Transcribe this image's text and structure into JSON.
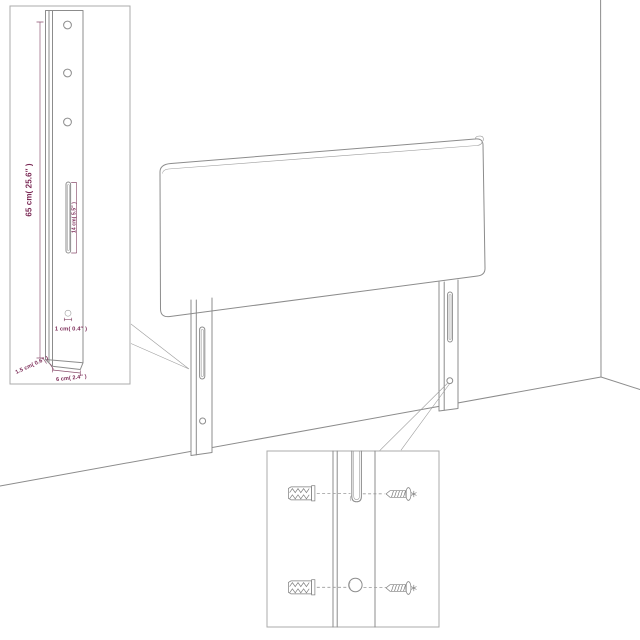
{
  "diagram": {
    "type": "furniture-assembly-illustration",
    "subject": "upholstered headboard with two wall-mount legs standing in a room corner",
    "insets": {
      "leg_detail": {
        "hole_count": 3,
        "labels": {
          "leg_height": "65 cm( 25.6″ )",
          "slot_length": "14 cm( 5.5″ )",
          "hook_depth": "1 cm( 0.4″ )",
          "leg_thickness": "1.5 cm( 0.6″ )",
          "leg_width": "6 cm( 2.4″ )"
        }
      },
      "mounting_detail": {
        "depicted_parts": [
          "wall-plug-icon",
          "screw-icon",
          "keyhole-slot",
          "screw-hole"
        ]
      }
    },
    "colors": {
      "dimension_text": "#7b2a56",
      "line_work": "#8c8c8c",
      "inset_border": "#ababab",
      "background": "#ffffff"
    }
  }
}
